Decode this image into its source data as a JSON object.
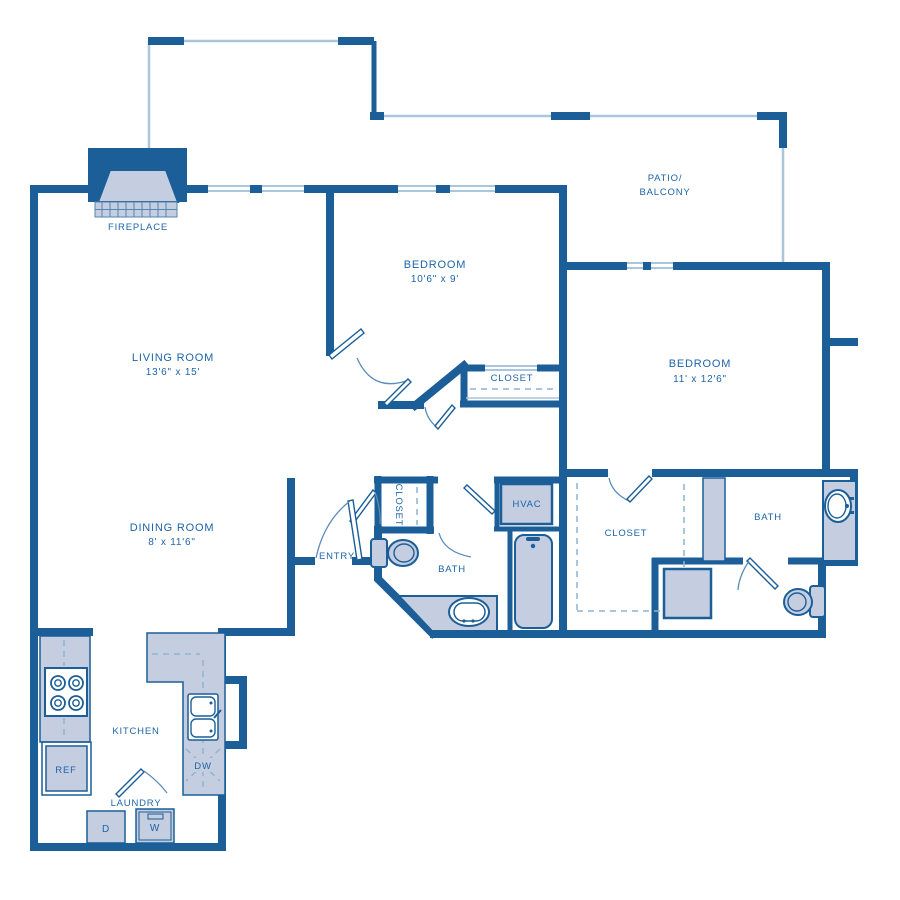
{
  "colors": {
    "wall": "#1b5e98",
    "fill": "#c5cde0",
    "light_line": "#a9c6dd",
    "text": "#1d64a8",
    "background": "#ffffff"
  },
  "rooms": {
    "living": {
      "name": "LIVING ROOM",
      "dims": "13'6\" x 15'"
    },
    "dining": {
      "name": "DINING ROOM",
      "dims": "8' x 11'6\""
    },
    "bedroom1": {
      "name": "BEDROOM",
      "dims": "10'6\" x 9'"
    },
    "bedroom2": {
      "name": "BEDROOM",
      "dims": "11' x 12'6\""
    },
    "patio": {
      "line1": "PATIO/",
      "line2": "BALCONY"
    },
    "entry": {
      "name": "ENTRY"
    },
    "kitchen": {
      "name": "KITCHEN"
    },
    "laundry": {
      "name": "LAUNDRY"
    },
    "bath1": {
      "name": "BATH"
    },
    "bath2": {
      "name": "BATH"
    },
    "closet_bedroom1": {
      "name": "CLOSET"
    },
    "closet_entry": {
      "name": "CLOSET"
    },
    "closet_walkin": {
      "name": "CLOSET"
    },
    "hvac": {
      "name": "HVAC"
    },
    "fireplace": {
      "name": "FIREPLACE"
    }
  },
  "appliances": {
    "refrigerator": "REF",
    "dishwasher": "DW",
    "dryer": "D",
    "washer": "W"
  }
}
